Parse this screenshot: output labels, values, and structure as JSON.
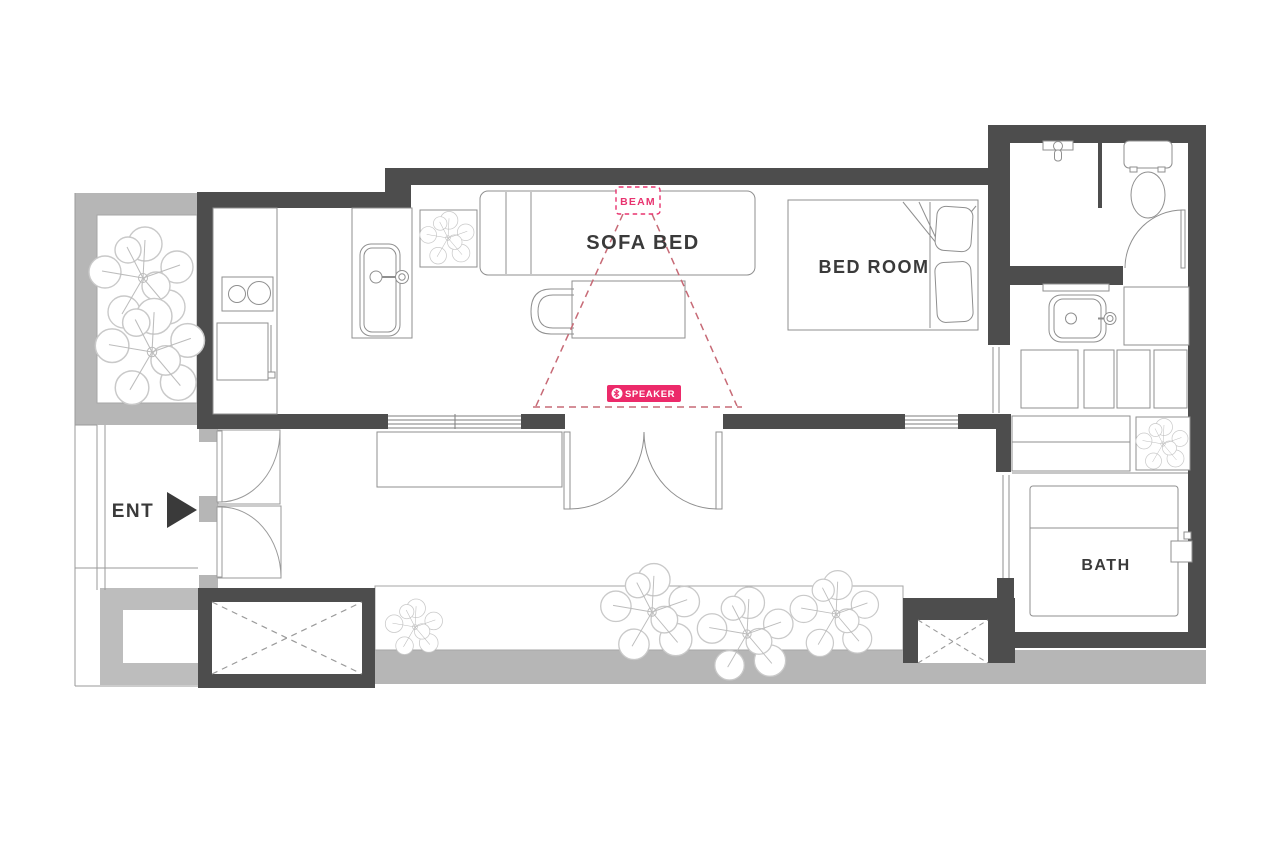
{
  "plan": {
    "type": "apartment-floor-plan",
    "labels": {
      "sofa_bed": "SOFA BED",
      "bed_room": "BED ROOM",
      "bath": "BATH",
      "entrance": "ENT",
      "beam": "BEAM",
      "speaker": "SPEAKER"
    },
    "icons": {
      "speaker_badge_icon": "bluetooth-icon",
      "entrance_icon": "right-arrow-icon",
      "greenery": "tree-icon"
    },
    "palette": {
      "wall_dark": "#4d4d4d",
      "wall_light": "#b6b6b6",
      "line": "#8f8f8f",
      "tree_line": "#c5c5c5",
      "accent_pink": "#e8336f",
      "beam_cone": "#c76a76",
      "label_text": "#3a3a3a",
      "background": "#ffffff"
    }
  }
}
